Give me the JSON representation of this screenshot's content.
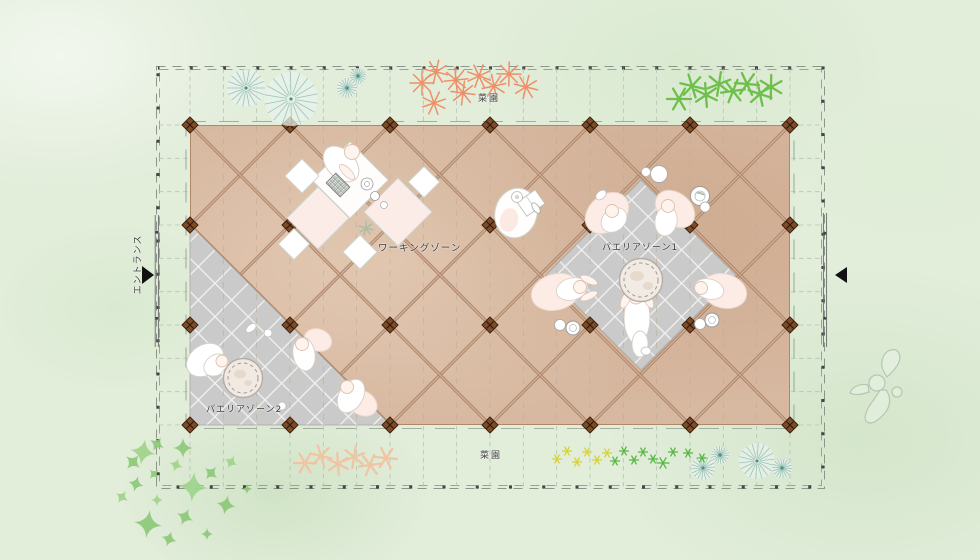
{
  "plan": {
    "labels": {
      "garden_top": "菜園",
      "garden_bottom": "菜園",
      "entrance": "エントランス",
      "zone_working": "ワーキングゾーン",
      "zone_paella1": "パエリアゾーン1",
      "zone_paella2": "パエリアゾーン2"
    },
    "colors": {
      "background_green": "#e2edda",
      "deck_wood": "#d7b8a0",
      "deck_seam": "#ab8165",
      "column_brown": "#7c4b27",
      "tile_gray": "#c9cac9",
      "tree_teal": "#96beb2",
      "plant_orange": "#ef8f68",
      "plant_green": "#6fbf4c",
      "plant_peach": "#f0c5a3",
      "sparkle_green": "#8cc878",
      "flower_yellow": "#d9d23a",
      "flower_green": "#58b845",
      "label_text": "#3b3b3b"
    }
  }
}
